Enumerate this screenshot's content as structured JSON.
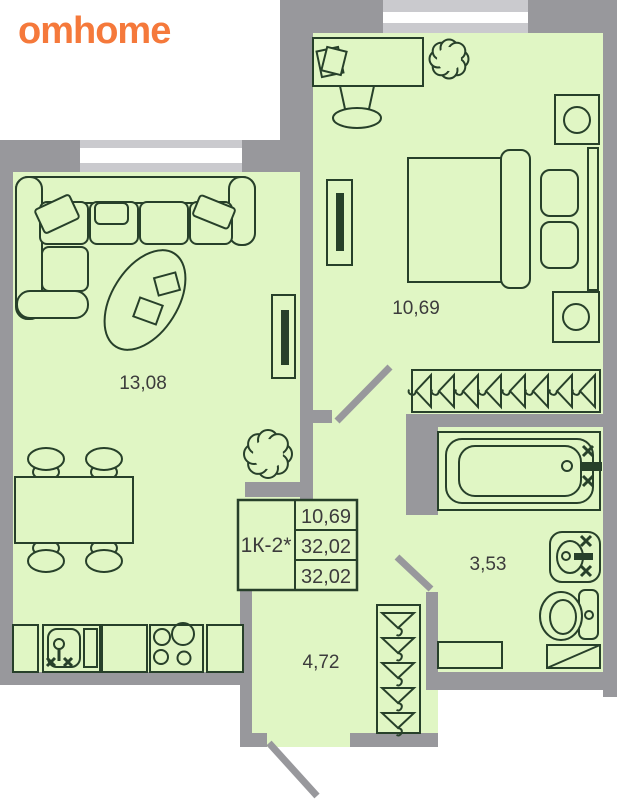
{
  "brand": {
    "logo": "omhome"
  },
  "unit_card": {
    "code": "1К-2*",
    "rows": [
      "10,69",
      "32,02",
      "32,02"
    ]
  },
  "rooms": {
    "living": "13,08",
    "bedroom": "10,69",
    "bathroom": "3,53",
    "hallway": "4,72"
  },
  "colors": {
    "brand_orange": "#f5793b",
    "floor_green": "#e0f6c4",
    "wall_gray": "#98989c",
    "outline_dark": "#27402a",
    "label_text": "#3c3c3c"
  },
  "icons": [
    "window",
    "door-swing",
    "corner-sofa",
    "sofa-pillow",
    "coffee-table",
    "tv",
    "dining-table",
    "chair",
    "plant",
    "kitchen-sink",
    "faucet-cross-handles",
    "stove-burners",
    "desk",
    "desk-chair",
    "bed",
    "pillow",
    "nightstand-lamp",
    "hanger",
    "wardrobe",
    "bathtub",
    "washbasin",
    "toilet",
    "shelf",
    "washing-machine"
  ]
}
